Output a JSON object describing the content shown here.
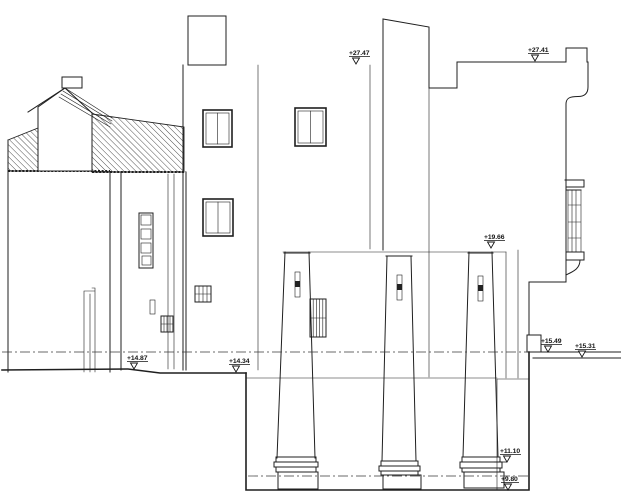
{
  "drawing": {
    "elevation_markers": {
      "roof_main": "+27.47",
      "roof_right": "+27.41",
      "architrave": "+19.66",
      "terrace_upper": "+15.49",
      "terrace_lower": "+15.31",
      "ground_left": "+14.87",
      "ground_mid": "+14.34",
      "column_base": "+11.10",
      "pit_floor": "+9.80"
    },
    "colors": {
      "ink": "#1f1f1f",
      "paper": "#ffffff"
    }
  }
}
